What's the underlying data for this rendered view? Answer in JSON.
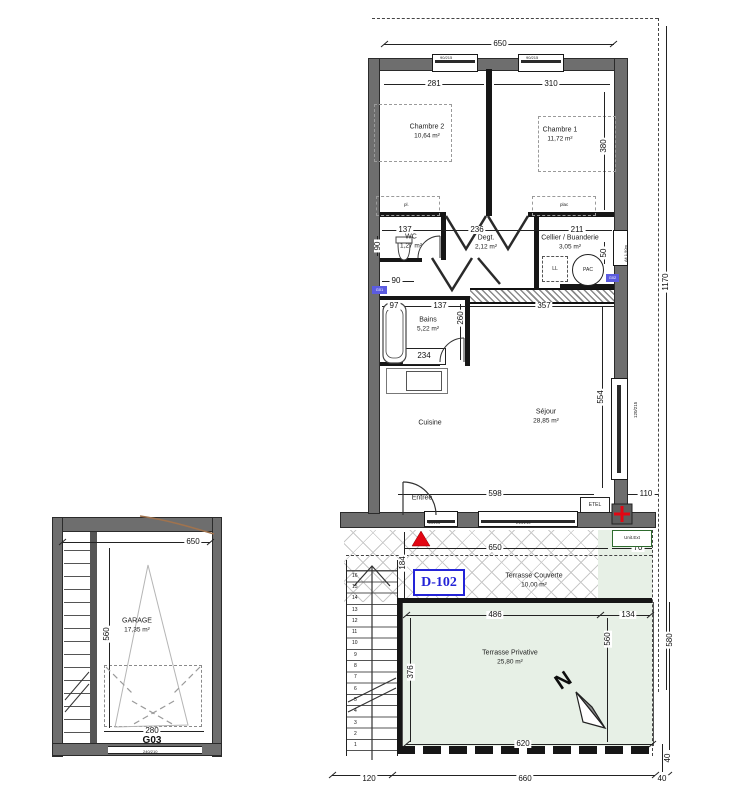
{
  "unit": {
    "id": "D-102"
  },
  "rooms": {
    "chambre2": {
      "name": "Chambre 2",
      "area": "10,64 m²"
    },
    "chambre1": {
      "name": "Chambre 1",
      "area": "11,72 m²"
    },
    "wc": {
      "name": "WC",
      "area": "1,27 m²"
    },
    "degt": {
      "name": "Degt.",
      "area": "2,12 m²"
    },
    "cellier": {
      "name": "Cellier / Buanderie",
      "area": "3,05 m²"
    },
    "bains": {
      "name": "Bains",
      "area": "5,22 m²"
    },
    "cuisine": {
      "name": "Cuisine"
    },
    "sejour": {
      "name": "Séjour",
      "area": "28,85 m²"
    },
    "entree": {
      "name": "Entrée"
    },
    "terrasse_couverte": {
      "name": "Terrasse Couverte",
      "area": "10,00 m²"
    },
    "terrasse_privative": {
      "name": "Terrasse Privative",
      "area": "25,80 m²"
    },
    "garage": {
      "name": "GARAGE",
      "area": "17,35 m²"
    }
  },
  "closets": {
    "left": "pl.",
    "right": "plac"
  },
  "equipment": {
    "pac": "PAC",
    "ll": "LL",
    "etel": "ETEL",
    "unit_ext": "Unit.Ext",
    "g01": "G01",
    "g02": "G02"
  },
  "windows": {
    "w1": "90/215",
    "w2": "90/215",
    "w3": "90/215",
    "w4": "210/215",
    "w5": "120/215",
    "w6": "Alt 1.90m"
  },
  "garage_info": {
    "code": "G03",
    "door": "240/210"
  },
  "north": "N",
  "stairs": [
    "16",
    "15",
    "14",
    "13",
    "12",
    "11",
    "10",
    "9",
    "8",
    "7",
    "6",
    "5",
    "4",
    "3",
    "2",
    "1"
  ],
  "dims": {
    "top_650": "650",
    "ch2_281": "281",
    "ch1_310": "310",
    "right_380": "380",
    "wc_137": "137",
    "degt_236": "236",
    "cellier_211": "211",
    "wc_90v": "90",
    "wc_90b": "90",
    "cellier_50v": "50",
    "bains_97": "97",
    "bains_137": "137",
    "bains_260v": "260",
    "bains_234": "234",
    "mid_357": "357",
    "sejour_554v": "554",
    "sejour_598": "598",
    "sejour_110": "110",
    "right_1170v": "1170",
    "tc_650": "650",
    "tc_70": "70",
    "tc_184v": "184",
    "tp_486": "486",
    "tp_134": "134",
    "tp_376v": "376",
    "tp_560v": "560",
    "tp_580v": "580",
    "tp_620": "620",
    "bot_120": "120",
    "bot_660": "660",
    "bot_40": "40",
    "right_40v": "40",
    "g_650": "650",
    "g_560v": "560",
    "g_280": "280"
  },
  "colors": {
    "accent_blue": "#2424d8",
    "marker_red": "#e30613",
    "terrace_green": "#e7f0e6",
    "wall_gray": "#6e6e6e",
    "revision_brown": "#a0734e"
  }
}
